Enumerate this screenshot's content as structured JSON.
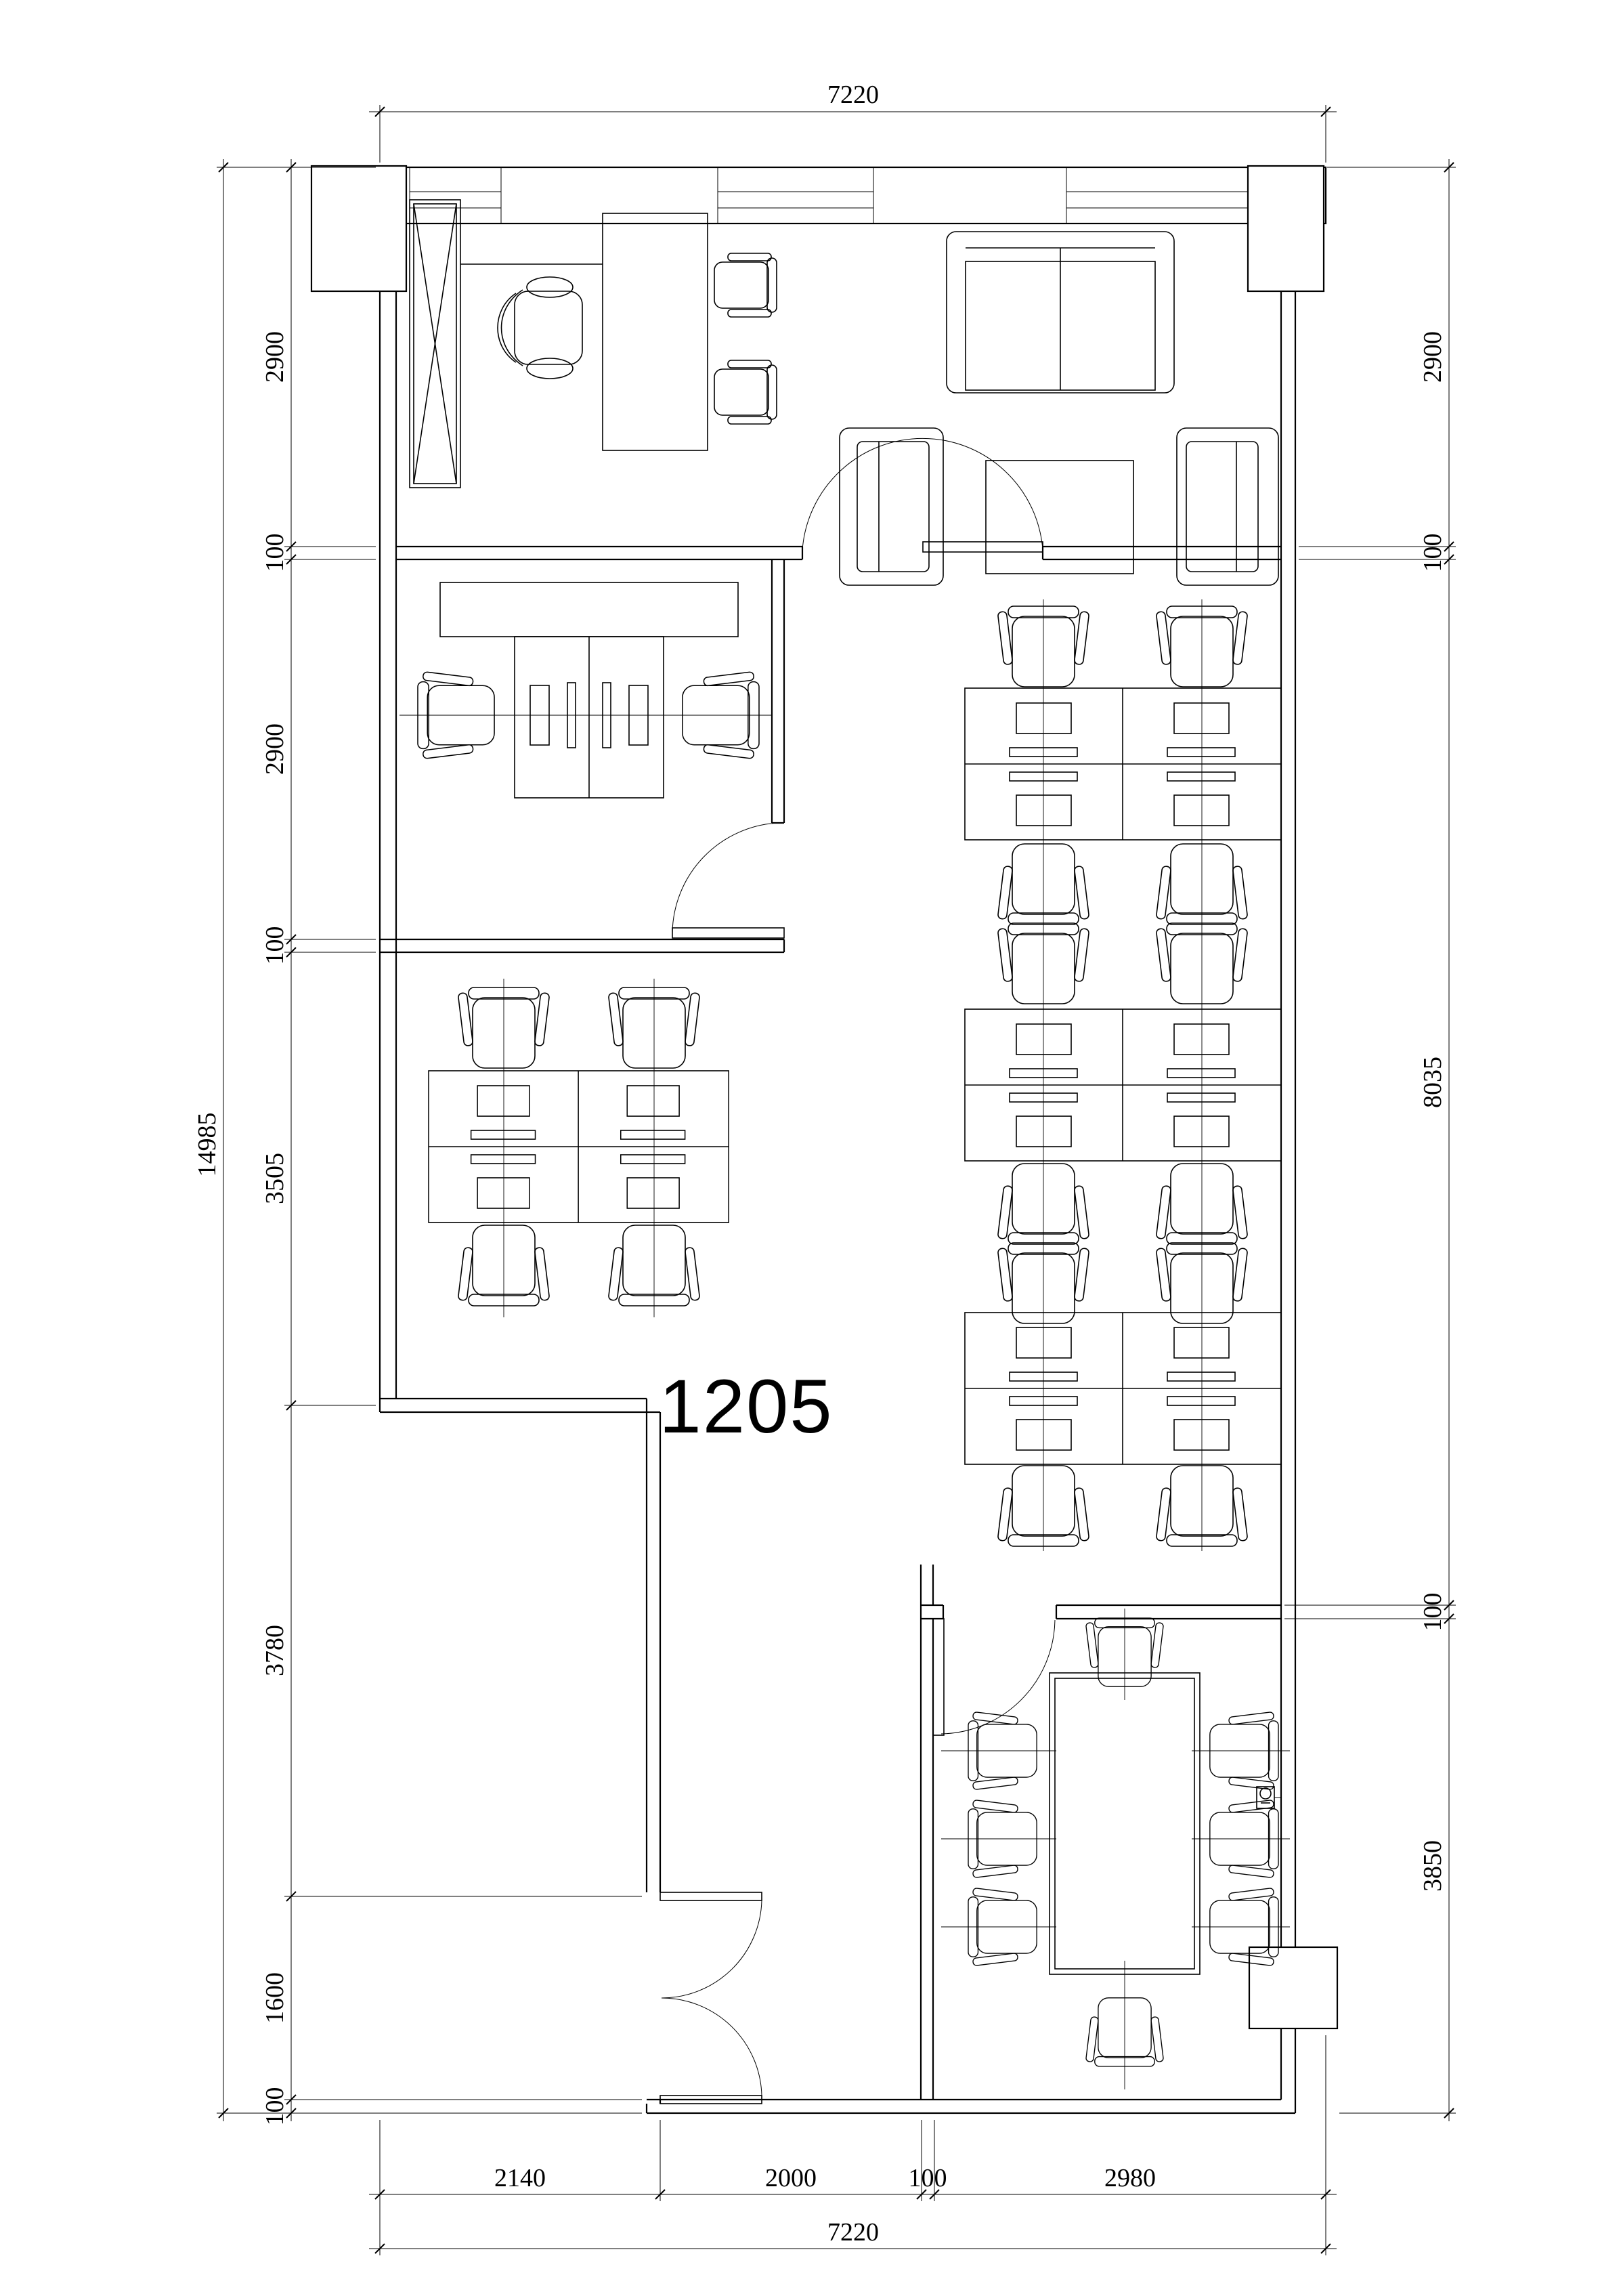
{
  "page": {
    "background": "#ffffff",
    "line_color": "#000000"
  },
  "floor_plan": {
    "room_label": "1205"
  },
  "dimensions": {
    "top": {
      "total": "7220"
    },
    "bottom": {
      "segments": [
        "2140",
        "2000",
        "100",
        "2980"
      ],
      "total": "7220"
    },
    "left": {
      "segments": [
        "2900",
        "100",
        "2900",
        "100",
        "3505",
        "3780",
        "1600",
        "100"
      ],
      "total": "14985"
    },
    "right": {
      "segments": [
        "2900",
        "100",
        "8035",
        "100",
        "3850"
      ]
    }
  },
  "icons": {
    "wall_socket_symbol": "circle-with-stem"
  }
}
